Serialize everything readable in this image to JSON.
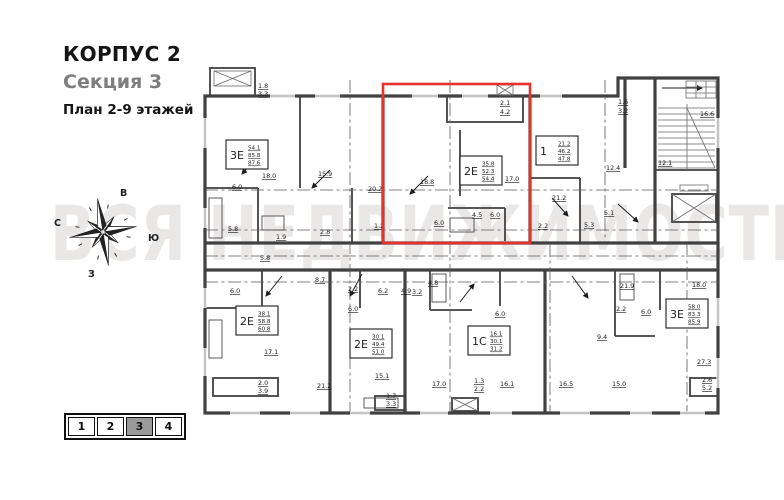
{
  "header": {
    "building": "КОРПУС 2",
    "section": "Секция 3",
    "plan_title": "План 2-9 этажей"
  },
  "watermark": "ВСЯ НЕДВИЖИМОСТЬ",
  "compass": {
    "top": "В",
    "left": "С",
    "right": "Ю",
    "bottom": "З"
  },
  "pagination": {
    "pages": [
      "1",
      "2",
      "3",
      "4"
    ],
    "active": "3"
  },
  "plan": {
    "highlight_color": "#e8312a",
    "apartments": [
      {
        "type": "3Е",
        "areas": [
          "54.1",
          "85.8",
          "87.6"
        ],
        "x": 26,
        "y": 82
      },
      {
        "type": "2Е",
        "areas": [
          "35.8",
          "52.3",
          "54.4"
        ],
        "x": 260,
        "y": 98
      },
      {
        "type": "1",
        "areas": [
          "21.2",
          "46.2",
          "47.8"
        ],
        "x": 336,
        "y": 78
      },
      {
        "type": "2Е",
        "areas": [
          "38.1",
          "58.8",
          "60.8"
        ],
        "x": 36,
        "y": 248
      },
      {
        "type": "2Е",
        "areas": [
          "30.1",
          "49.4",
          "51.0"
        ],
        "x": 150,
        "y": 271
      },
      {
        "type": "1С",
        "areas": [
          "16.1",
          "30.1",
          "31.2"
        ],
        "x": 268,
        "y": 268
      },
      {
        "type": "3Е",
        "areas": [
          "58.0",
          "83.3",
          "85.9"
        ],
        "x": 466,
        "y": 241
      }
    ],
    "room_labels": [
      {
        "t": "1.8",
        "x": 58,
        "y": 30
      },
      {
        "t": "3.3",
        "x": 58,
        "y": 38
      },
      {
        "t": "18.0",
        "x": 62,
        "y": 120
      },
      {
        "t": "15.9",
        "x": 118,
        "y": 118
      },
      {
        "t": "20.2",
        "x": 168,
        "y": 133
      },
      {
        "t": "6.0",
        "x": 32,
        "y": 131
      },
      {
        "t": "5.8",
        "x": 28,
        "y": 173
      },
      {
        "t": "1.9",
        "x": 76,
        "y": 181
      },
      {
        "t": "2.8",
        "x": 120,
        "y": 176
      },
      {
        "t": "1.2",
        "x": 174,
        "y": 170
      },
      {
        "t": "2.1",
        "x": 300,
        "y": 47
      },
      {
        "t": "4.2",
        "x": 300,
        "y": 56
      },
      {
        "t": "18.8",
        "x": 220,
        "y": 126
      },
      {
        "t": "17.0",
        "x": 305,
        "y": 123
      },
      {
        "t": "4.5",
        "x": 272,
        "y": 159
      },
      {
        "t": "6.0",
        "x": 290,
        "y": 159
      },
      {
        "t": "6.0",
        "x": 234,
        "y": 167
      },
      {
        "t": "21.2",
        "x": 352,
        "y": 142
      },
      {
        "t": "2.2",
        "x": 338,
        "y": 170
      },
      {
        "t": "5.1",
        "x": 404,
        "y": 157
      },
      {
        "t": "5.3",
        "x": 384,
        "y": 169
      },
      {
        "t": "1.6",
        "x": 418,
        "y": 46
      },
      {
        "t": "3.2",
        "x": 418,
        "y": 55
      },
      {
        "t": "12.4",
        "x": 406,
        "y": 112
      },
      {
        "t": "12.1",
        "x": 458,
        "y": 107
      },
      {
        "t": "16.6",
        "x": 500,
        "y": 58
      },
      {
        "t": "5.8",
        "x": 60,
        "y": 202
      },
      {
        "t": "6.0",
        "x": 30,
        "y": 235
      },
      {
        "t": "8.7",
        "x": 115,
        "y": 224
      },
      {
        "t": "17.1",
        "x": 64,
        "y": 296
      },
      {
        "t": "2.0",
        "x": 58,
        "y": 327
      },
      {
        "t": "3.9",
        "x": 58,
        "y": 335
      },
      {
        "t": "21.2",
        "x": 117,
        "y": 330
      },
      {
        "t": "2.2",
        "x": 148,
        "y": 233
      },
      {
        "t": "6.2",
        "x": 178,
        "y": 235
      },
      {
        "t": "6.0",
        "x": 148,
        "y": 253
      },
      {
        "t": "4.9",
        "x": 201,
        "y": 235
      },
      {
        "t": "15.1",
        "x": 175,
        "y": 320
      },
      {
        "t": "17.0",
        "x": 232,
        "y": 328
      },
      {
        "t": "1.3",
        "x": 274,
        "y": 325
      },
      {
        "t": "2.2",
        "x": 274,
        "y": 333
      },
      {
        "t": "3.2",
        "x": 212,
        "y": 236
      },
      {
        "t": "4.8",
        "x": 228,
        "y": 227
      },
      {
        "t": "6.0",
        "x": 295,
        "y": 258
      },
      {
        "t": "16.1",
        "x": 300,
        "y": 328
      },
      {
        "t": "1.7",
        "x": 186,
        "y": 340
      },
      {
        "t": "3.3",
        "x": 186,
        "y": 348
      },
      {
        "t": "16.5",
        "x": 359,
        "y": 328
      },
      {
        "t": "21.9",
        "x": 420,
        "y": 230
      },
      {
        "t": "18.0",
        "x": 492,
        "y": 229
      },
      {
        "t": "2.2",
        "x": 416,
        "y": 253
      },
      {
        "t": "6.0",
        "x": 441,
        "y": 256
      },
      {
        "t": "9.4",
        "x": 397,
        "y": 281
      },
      {
        "t": "27.3",
        "x": 497,
        "y": 306
      },
      {
        "t": "15.0",
        "x": 412,
        "y": 328
      },
      {
        "t": "2.6",
        "x": 502,
        "y": 324
      },
      {
        "t": "5.2",
        "x": 502,
        "y": 332
      }
    ]
  }
}
